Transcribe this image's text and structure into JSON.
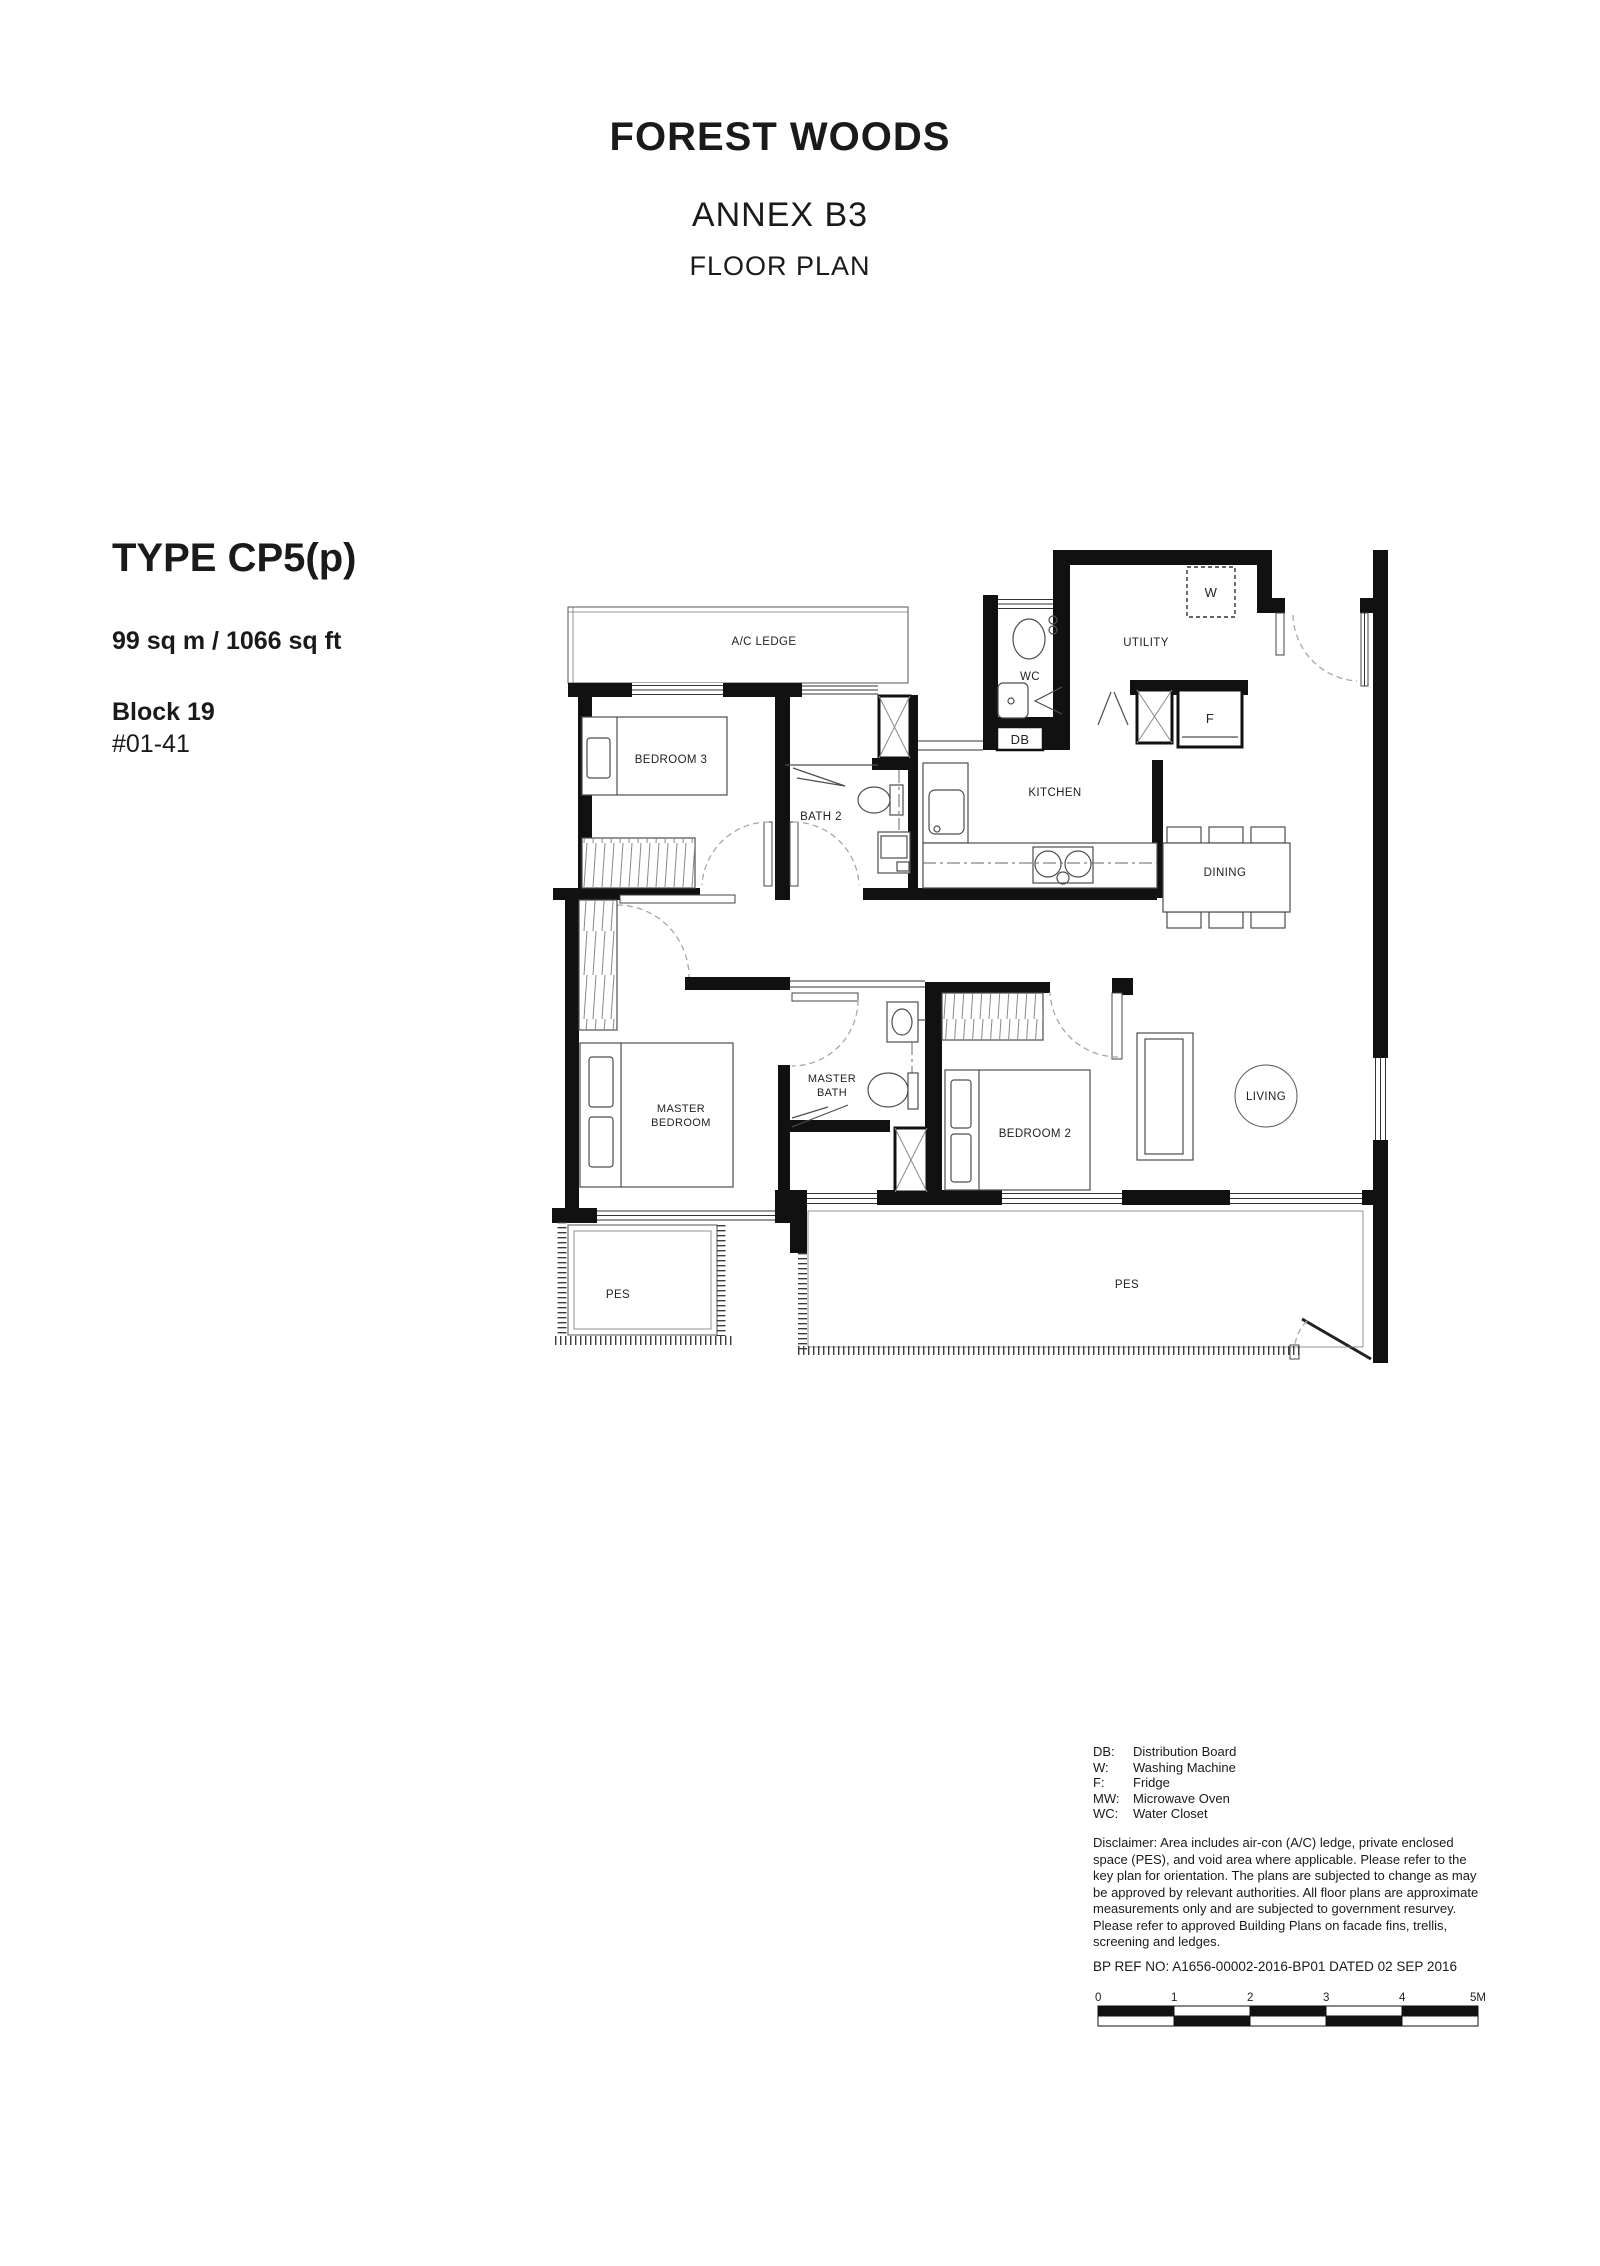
{
  "header": {
    "title": "FOREST WOODS",
    "subtitle": "ANNEX B3",
    "caption": "FLOOR PLAN"
  },
  "unit_info": {
    "type": "TYPE CP5(p)",
    "area": "99 sq m / 1066 sq ft",
    "block": "Block 19",
    "unit": "#01-41"
  },
  "rooms": {
    "ac_ledge": "A/C LEDGE",
    "bedroom3": "BEDROOM 3",
    "bath2": "BATH 2",
    "wc": "WC",
    "utility": "UTILITY",
    "db": "DB",
    "washer": "W",
    "fridge": "F",
    "kitchen": "KITCHEN",
    "dining": "DINING",
    "living": "LIVING",
    "master_bath_line1": "MASTER",
    "master_bath_line2": "BATH",
    "master_bedroom_line1": "MASTER",
    "master_bedroom_line2": "BEDROOM",
    "bedroom2": "BEDROOM 2",
    "pes_left": "PES",
    "pes_right": "PES"
  },
  "legend": {
    "items": [
      {
        "key": "DB:",
        "value": "Distribution Board"
      },
      {
        "key": "W:",
        "value": "Washing Machine"
      },
      {
        "key": "F:",
        "value": "Fridge"
      },
      {
        "key": "MW:",
        "value": "Microwave Oven"
      },
      {
        "key": "WC:",
        "value": "Water Closet"
      }
    ]
  },
  "disclaimer": {
    "lines": [
      "Disclaimer: Area includes air-con (A/C) ledge, private enclosed",
      "space (PES), and void area where applicable.  Please refer to the",
      "key plan for orientation.  The plans are subjected to change as may",
      "be approved by relevant authorities.  All floor plans are approximate",
      "measurements only and are subjected to government resurvey.",
      "Please refer to approved Building Plans on facade fins, trellis,",
      "screening and ledges."
    ]
  },
  "bp_ref": "BP REF NO:  A1656-00002-2016-BP01 DATED 02 SEP 2016",
  "scale_bar": {
    "labels": [
      "0",
      "1",
      "2",
      "3",
      "4",
      "5M"
    ]
  }
}
